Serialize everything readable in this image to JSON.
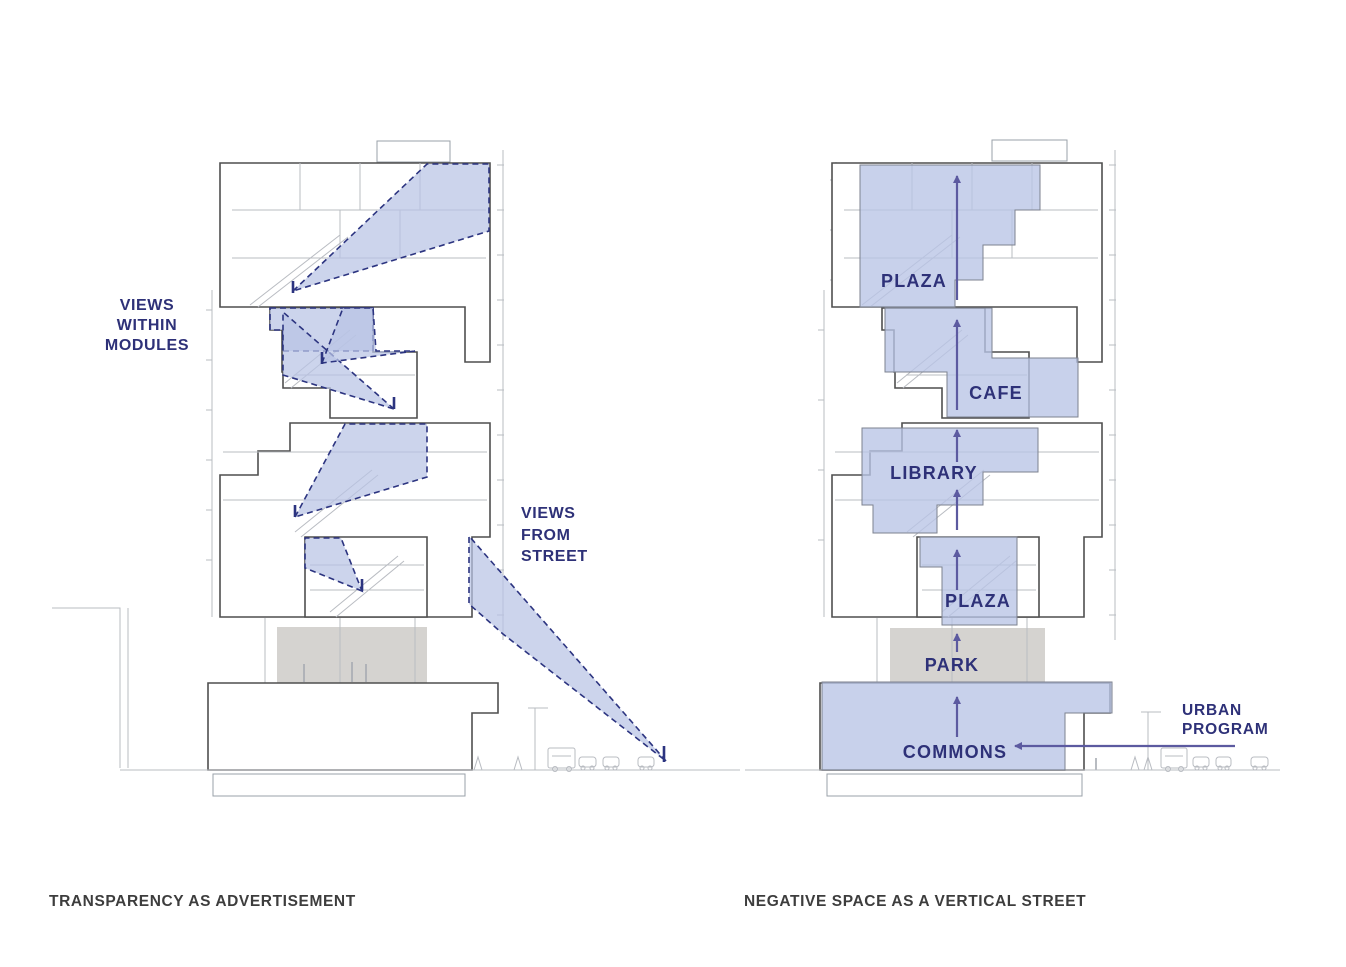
{
  "colors": {
    "label_navy": "#2e3178",
    "arrow_purple": "#5c5aa0",
    "cone_fill": "#c7d0ea",
    "cone_border": "#2c3480",
    "building_outline": "#4f4f4f",
    "detail_gray": "#b9bcc2",
    "park_gray": "#d5d3d0",
    "caption_dark": "#3d3d3d",
    "background": "#ffffff"
  },
  "left": {
    "caption": "TRANSPARENCY AS ADVERTISEMENT",
    "views_within": [
      "VIEWS",
      "WITHIN",
      "MODULES"
    ],
    "views_from": [
      "VIEWS",
      "FROM",
      "STREET"
    ]
  },
  "right": {
    "caption": "NEGATIVE SPACE AS A VERTICAL STREET",
    "programs": {
      "plaza_top": "PLAZA",
      "cafe": "CAFE",
      "library": "LIBRARY",
      "plaza_lower": "PLAZA",
      "park": "PARK",
      "commons": "COMMONS"
    },
    "urban_program": [
      "URBAN",
      "PROGRAM"
    ]
  }
}
